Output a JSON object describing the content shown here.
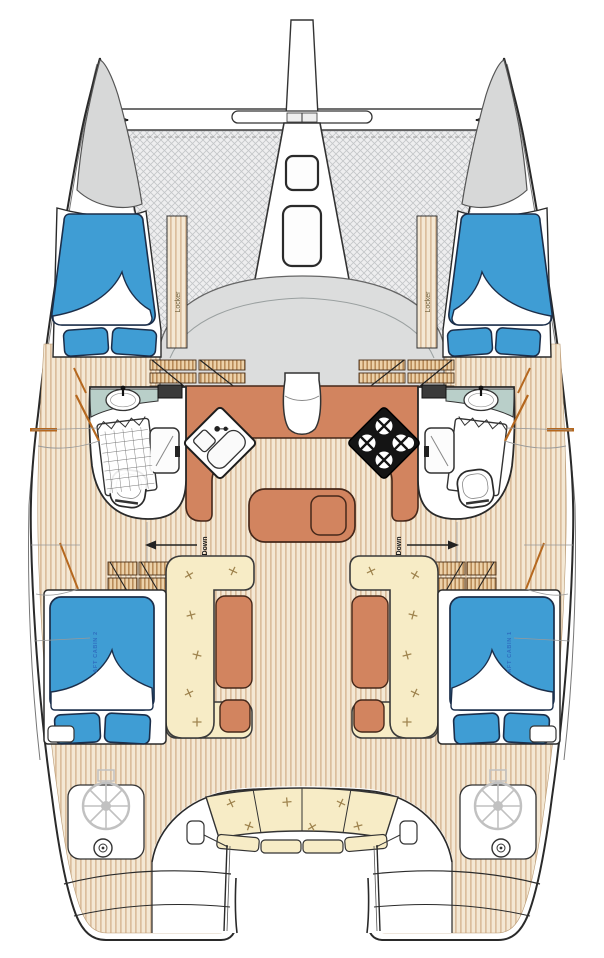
{
  "diagram": {
    "kind": "catamaran-sailboat-floor-plan",
    "labels": {
      "locker_port": "Locker",
      "locker_starboard": "Locker",
      "down_port": "Down",
      "down_starboard": "Down",
      "aft_cabin_port": "AFT CABIN 2",
      "aft_cabin_starboard": "AFT CABIN 1"
    },
    "colors": {
      "bed_blue": "#3f9dd4",
      "bed_outline": "#1b2e4a",
      "wood_base": "#f4e8d4",
      "wood_stripe": "#d2b08a",
      "counter_terracotta": "#d2845f",
      "counter_outline": "#46281a",
      "cushion_cream": "#f7ecc6",
      "counter_teal": "#b9cfc9",
      "coachroof_gray": "#dcdddd",
      "bow_gray": "#d7d8d8",
      "net_gray": "#eeeeef",
      "label_blue": "#2f6fc0",
      "door_accent": "#b5681f"
    }
  }
}
